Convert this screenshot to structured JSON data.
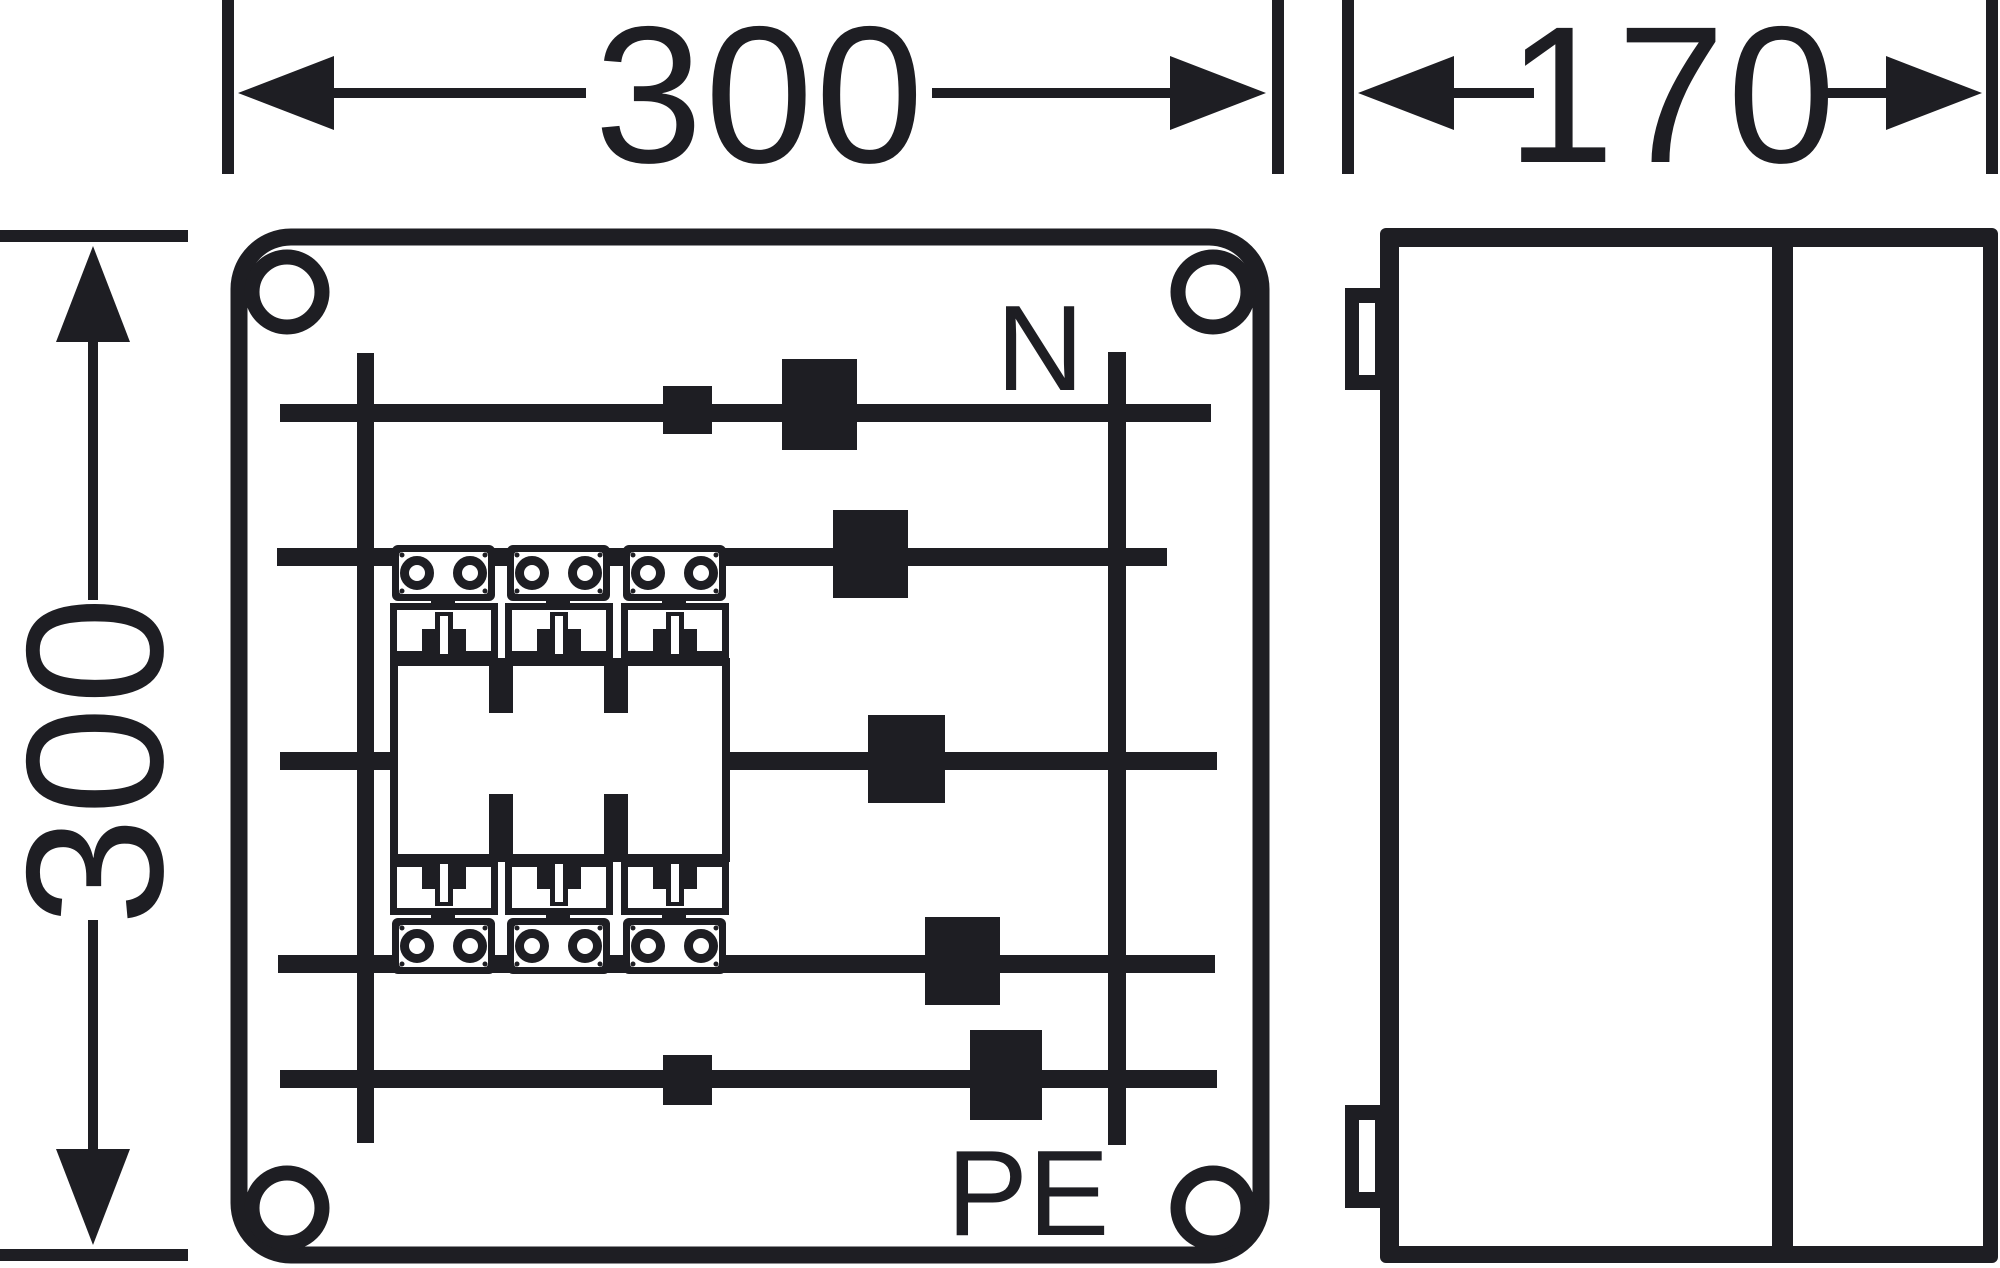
{
  "drawing": {
    "description": "Enclosure dimensional drawing with front view and side view",
    "front_view": {
      "width_dimension": "300",
      "height_dimension": "300",
      "busbar_labels": {
        "neutral": "N",
        "earth": "PE"
      }
    },
    "side_view": {
      "depth_dimension": "170"
    },
    "colors": {
      "ink": "#1e1e23",
      "paper": "#ffffff"
    }
  }
}
